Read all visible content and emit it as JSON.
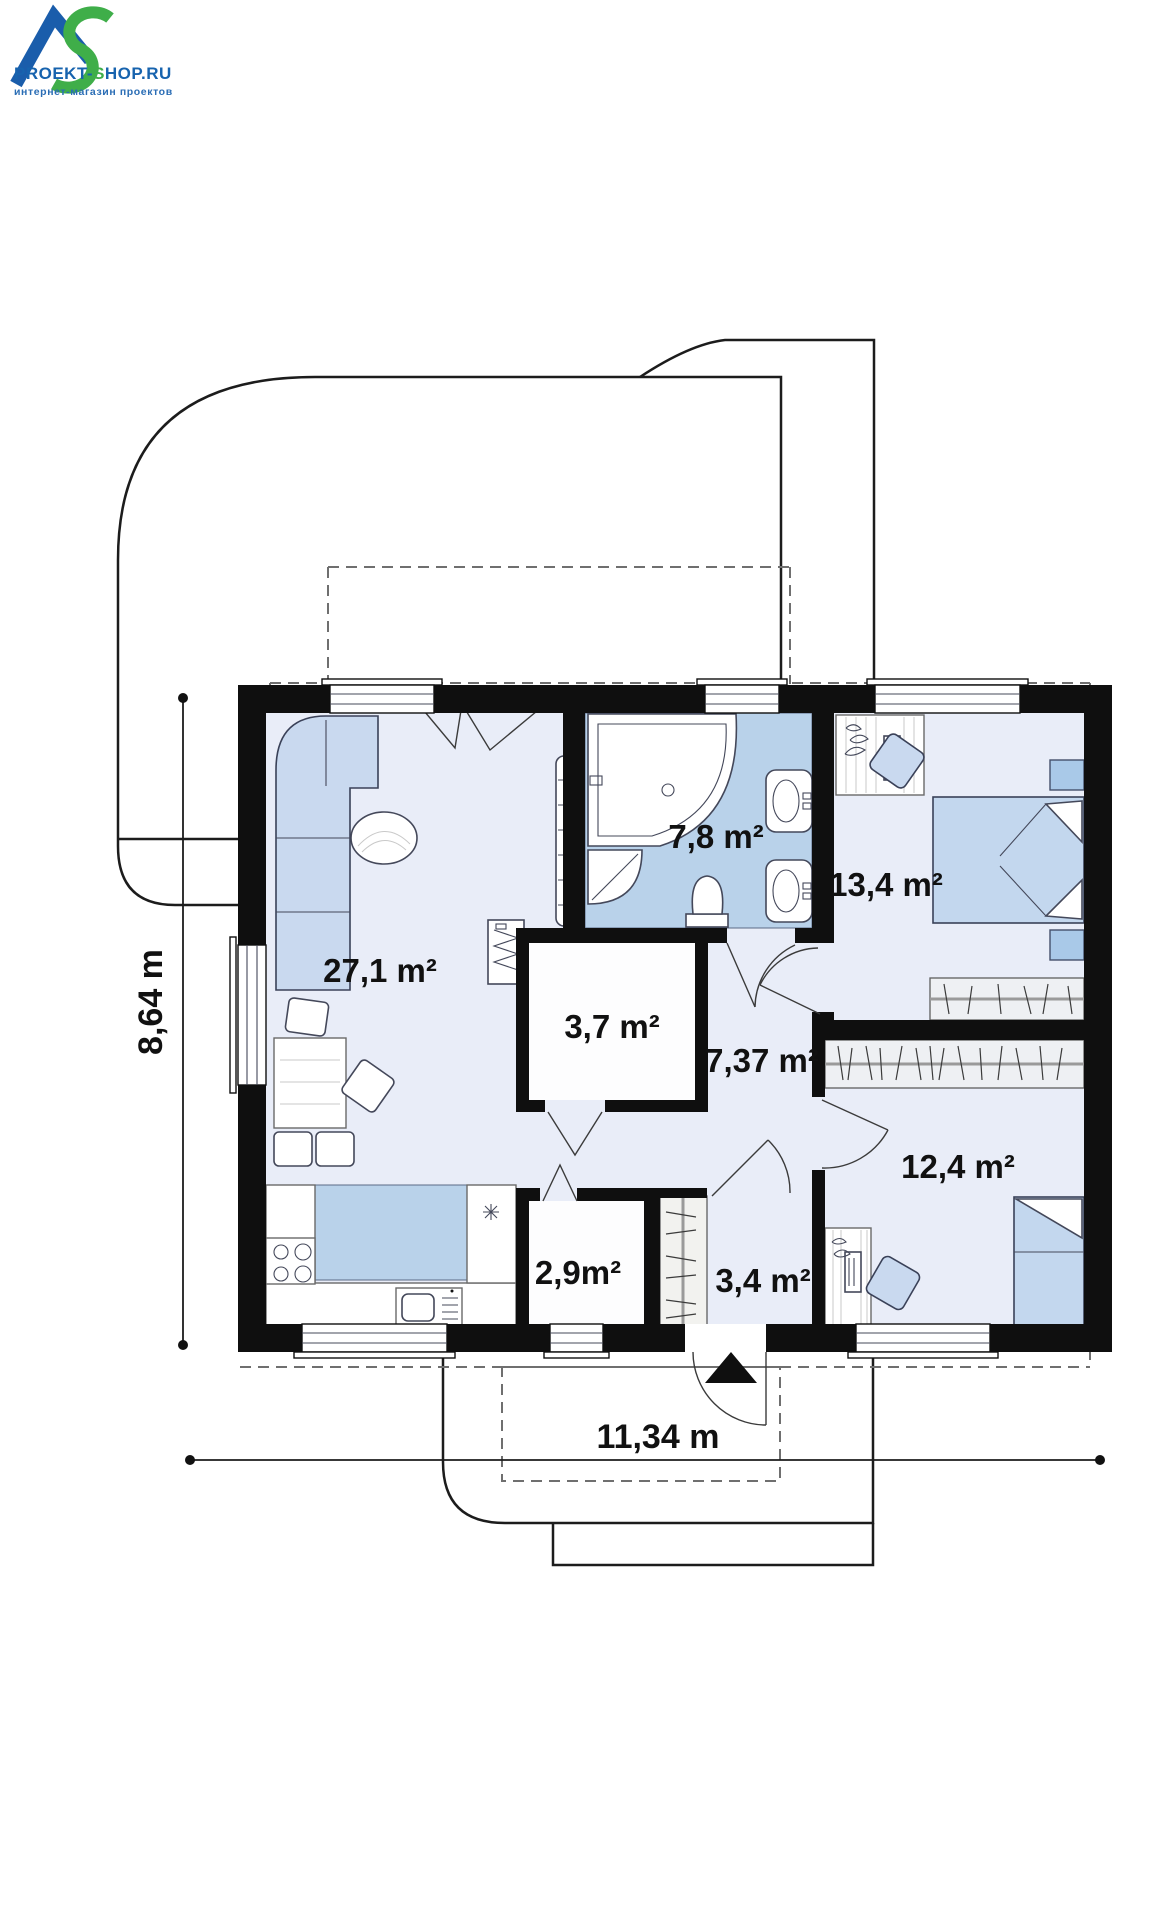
{
  "logo": {
    "title_part1": "PROEKT-",
    "title_part2": "S",
    "title_part3": "HOP.RU",
    "subtitle": "интернет-магазин проектов",
    "colors": {
      "blue": "#1763ae",
      "green": "#3fae49"
    }
  },
  "plan": {
    "rooms": [
      {
        "name": "living-room-kitchen",
        "area_label": "27,1 m²"
      },
      {
        "name": "bathroom",
        "area_label": "7,8 m²"
      },
      {
        "name": "bedroom-top-right",
        "area_label": "13,4 m²"
      },
      {
        "name": "tech-room",
        "area_label": "3,7 m²"
      },
      {
        "name": "hallway",
        "area_label": "7,37 m²"
      },
      {
        "name": "bedroom-bottom-right",
        "area_label": "12,4 m²"
      },
      {
        "name": "pantry",
        "area_label": "2,9m²"
      },
      {
        "name": "entry",
        "area_label": "3,4 m²"
      }
    ],
    "dimensions": {
      "height": "8,64 m",
      "width": "11,34 m"
    },
    "colors": {
      "wall": "#0f0f0f",
      "floor": "#e9edf8",
      "wet_zone": "#b9d2ea",
      "furniture_blue": "#c9d9ef",
      "white_room": "#fdfdfe"
    }
  }
}
